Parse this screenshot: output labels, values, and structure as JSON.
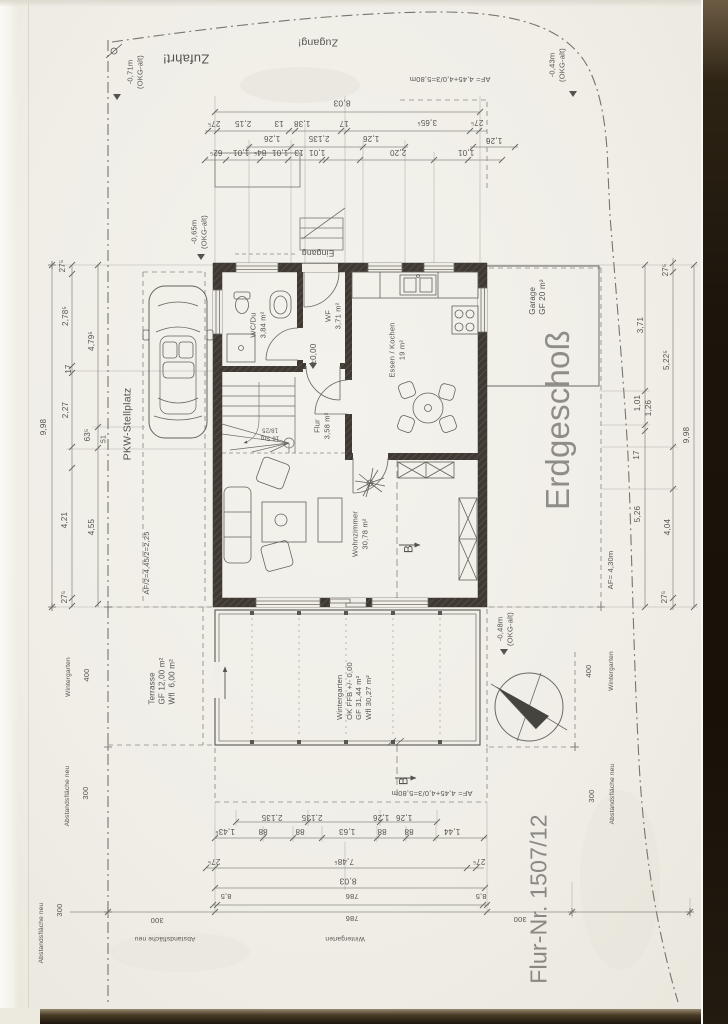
{
  "meta": {
    "document_type": "Scanned architectural floor plan",
    "floor_title": "Erdgeschoß",
    "parcel_number": "Flur-Nr. 1507/12"
  },
  "palette": {
    "paper": "#f0eee7",
    "ink": "#55534d",
    "wall": "#3f3933",
    "dim_line": "#8d8c85",
    "big_title": "#8f8d87",
    "scan_edge_dark": "#1b150c"
  },
  "annotations": [
    {
      "name": "label-zufahrt",
      "text": "Zufahrt!",
      "x": 186,
      "y": 58,
      "rot": 180,
      "size": 13
    },
    {
      "name": "label-zugang",
      "text": "Zugang!",
      "x": 318,
      "y": 42,
      "rot": 180,
      "size": 10.5
    },
    {
      "name": "level-note-071",
      "text": "-0,71m\n(OKG-alt)",
      "x": 135,
      "y": 72,
      "rot": -90,
      "size": 7.5
    },
    {
      "name": "level-note-043",
      "text": "-0,43m\n(OKG-alt)",
      "x": 557,
      "y": 65,
      "rot": -90,
      "size": 7.5
    },
    {
      "name": "af-formula-top",
      "text": "AF= 4,45+4,0/3=5,80m",
      "x": 450,
      "y": 79,
      "rot": 180,
      "size": 7.5
    },
    {
      "name": "dim-top-total",
      "text": "8,03",
      "x": 342,
      "y": 103,
      "rot": 180,
      "size": 8.5
    },
    {
      "name": "dim",
      "text": "27⁵",
      "x": 214,
      "y": 123,
      "rot": 180,
      "size": 8
    },
    {
      "name": "dim",
      "text": "2,15",
      "x": 243,
      "y": 123,
      "rot": 180,
      "size": 8
    },
    {
      "name": "dim",
      "text": "13",
      "x": 279,
      "y": 123,
      "rot": 180,
      "size": 8
    },
    {
      "name": "dim",
      "text": "1,38",
      "x": 302,
      "y": 123,
      "rot": 180,
      "size": 8
    },
    {
      "name": "dim",
      "text": "17",
      "x": 344,
      "y": 123,
      "rot": 180,
      "size": 8
    },
    {
      "name": "dim",
      "text": "3,65⁵",
      "x": 427,
      "y": 122,
      "rot": 180,
      "size": 8
    },
    {
      "name": "dim",
      "text": "27⁵",
      "x": 477,
      "y": 122,
      "rot": 180,
      "size": 8
    },
    {
      "name": "dim",
      "text": "1,26",
      "x": 272,
      "y": 138,
      "rot": 180,
      "size": 8
    },
    {
      "name": "dim",
      "text": "2,135",
      "x": 319,
      "y": 138,
      "rot": 180,
      "size": 8
    },
    {
      "name": "dim",
      "text": "1,26",
      "x": 371,
      "y": 138,
      "rot": 180,
      "size": 8
    },
    {
      "name": "dim",
      "text": "1,26",
      "x": 494,
      "y": 140,
      "rot": 180,
      "size": 8
    },
    {
      "name": "dim",
      "text": "62⁵",
      "x": 216,
      "y": 152,
      "rot": 180,
      "size": 8
    },
    {
      "name": "dim",
      "text": "1,01",
      "x": 241,
      "y": 152,
      "rot": 180,
      "size": 8
    },
    {
      "name": "dim",
      "text": "84⁵",
      "x": 260,
      "y": 152,
      "rot": 180,
      "size": 8
    },
    {
      "name": "dim",
      "text": "1,01",
      "x": 280,
      "y": 152,
      "rot": 180,
      "size": 8
    },
    {
      "name": "dim",
      "text": "13",
      "x": 299,
      "y": 152,
      "rot": 180,
      "size": 8
    },
    {
      "name": "dim",
      "text": "1,01",
      "x": 317,
      "y": 152,
      "rot": 180,
      "size": 8
    },
    {
      "name": "dim",
      "text": "2,20",
      "x": 398,
      "y": 152,
      "rot": 180,
      "size": 8
    },
    {
      "name": "dim",
      "text": "1,01",
      "x": 466,
      "y": 152,
      "rot": 180,
      "size": 8
    },
    {
      "name": "label-eingang",
      "text": "Eingang",
      "x": 318,
      "y": 253,
      "rot": 180,
      "size": 8.5
    },
    {
      "name": "level-note-065",
      "text": "-0,65m\n(OKG-alt)",
      "x": 199,
      "y": 232,
      "rot": -90,
      "size": 7.5
    },
    {
      "name": "room-wc",
      "text": "WC/Du\n3,84 m²",
      "x": 258,
      "y": 325,
      "rot": -90,
      "size": 7.5
    },
    {
      "name": "room-wf",
      "text": "WF\n3,71 m²",
      "x": 333,
      "y": 316,
      "rot": -90,
      "size": 7.5
    },
    {
      "name": "level-zero",
      "text": "±0,00",
      "x": 314,
      "y": 354,
      "rot": -90,
      "size": 8
    },
    {
      "name": "room-essen-kochen",
      "text": "Essen / Kochen\n19 m²",
      "x": 397,
      "y": 350,
      "rot": -90,
      "size": 7.5
    },
    {
      "name": "room-flur",
      "text": "Flur\n3,58 m²",
      "x": 322,
      "y": 426,
      "rot": -90,
      "size": 7.5
    },
    {
      "name": "stair-note",
      "text": "16 Stg\n18/25",
      "x": 270,
      "y": 433,
      "rot": 180,
      "size": 6
    },
    {
      "name": "room-wohnzimmer",
      "text": "Wohnzimmer\n30,78 m²",
      "x": 360,
      "y": 534,
      "rot": -90,
      "size": 7.5
    },
    {
      "name": "room-garage",
      "text": "Garage\nGF 20 m²",
      "x": 538,
      "y": 297,
      "rot": -90,
      "size": 8,
      "align": "left"
    },
    {
      "name": "floor-title",
      "text": "Erdgeschoß",
      "x": 558,
      "y": 420,
      "rot": -90,
      "size": 33,
      "color": "#8f8d87"
    },
    {
      "name": "parcel-number",
      "text": "Flur-Nr. 1507/12",
      "x": 539,
      "y": 899,
      "rot": -90,
      "size": 23,
      "color": "#8a8882"
    },
    {
      "name": "label-pkw-stellplatz",
      "text": "PKW-Stellplatz",
      "x": 128,
      "y": 424,
      "rot": -90,
      "size": 10.5
    },
    {
      "name": "dim",
      "text": "9,98",
      "x": 44,
      "y": 427,
      "rot": -90,
      "size": 8
    },
    {
      "name": "dim",
      "text": "27⁵",
      "x": 63,
      "y": 266,
      "rot": -90,
      "size": 8
    },
    {
      "name": "dim",
      "text": "2,78⁵",
      "x": 66,
      "y": 316,
      "rot": -90,
      "size": 8
    },
    {
      "name": "dim",
      "text": "17",
      "x": 69,
      "y": 369,
      "rot": -90,
      "size": 8
    },
    {
      "name": "dim",
      "text": "2,27",
      "x": 66,
      "y": 410,
      "rot": -90,
      "size": 8
    },
    {
      "name": "dim",
      "text": "4,21",
      "x": 65,
      "y": 520,
      "rot": -90,
      "size": 8
    },
    {
      "name": "dim",
      "text": "27⁵",
      "x": 65,
      "y": 597,
      "rot": -90,
      "size": 8
    },
    {
      "name": "dim",
      "text": "4,79⁵",
      "x": 92,
      "y": 341,
      "rot": -90,
      "size": 8
    },
    {
      "name": "dim",
      "text": "63⁵",
      "x": 88,
      "y": 435,
      "rot": -90,
      "size": 8
    },
    {
      "name": "dim",
      "text": "4,55",
      "x": 92,
      "y": 527,
      "rot": -90,
      "size": 8
    },
    {
      "name": "dim",
      "text": "51",
      "x": 105,
      "y": 439,
      "rot": -90,
      "size": 7
    },
    {
      "name": "af-formula-half",
      "text": "AF/2=4,45/2=2,25",
      "x": 147,
      "y": 563,
      "rot": -90,
      "size": 7.5
    },
    {
      "name": "zone-label",
      "text": "Wintergarten",
      "x": 69,
      "y": 677,
      "rot": -90,
      "size": 6.5
    },
    {
      "name": "zone-dim",
      "text": "400",
      "x": 87,
      "y": 675,
      "rot": -90,
      "size": 7.5
    },
    {
      "name": "zone-label",
      "text": "Abstandsfläche neu",
      "x": 68,
      "y": 796,
      "rot": -90,
      "size": 6.5
    },
    {
      "name": "zone-dim",
      "text": "300",
      "x": 86,
      "y": 793,
      "rot": -90,
      "size": 7.5
    },
    {
      "name": "zone-label",
      "text": "Abstandsfläche neu",
      "x": 42,
      "y": 933,
      "rot": -90,
      "size": 6.5
    },
    {
      "name": "zone-dim",
      "text": "300",
      "x": 60,
      "y": 910,
      "rot": -90,
      "size": 7.5
    },
    {
      "name": "dim",
      "text": "3,71",
      "x": 641,
      "y": 325,
      "rot": -90,
      "size": 8
    },
    {
      "name": "dim",
      "text": "1,01",
      "x": 638,
      "y": 403,
      "rot": -90,
      "size": 8
    },
    {
      "name": "dim",
      "text": "17",
      "x": 637,
      "y": 455,
      "rot": -90,
      "size": 8
    },
    {
      "name": "dim",
      "text": "5,26",
      "x": 638,
      "y": 514,
      "rot": -90,
      "size": 8
    },
    {
      "name": "dim",
      "text": "27⁵",
      "x": 666,
      "y": 270,
      "rot": -90,
      "size": 8
    },
    {
      "name": "dim",
      "text": "5,22⁵",
      "x": 667,
      "y": 360,
      "rot": -90,
      "size": 8
    },
    {
      "name": "dim",
      "text": "1,26",
      "x": 649,
      "y": 408,
      "rot": -90,
      "size": 8
    },
    {
      "name": "dim",
      "text": "4,04",
      "x": 668,
      "y": 527,
      "rot": -90,
      "size": 8
    },
    {
      "name": "dim",
      "text": "27⁵",
      "x": 665,
      "y": 597,
      "rot": -90,
      "size": 8
    },
    {
      "name": "dim",
      "text": "9,98",
      "x": 687,
      "y": 435,
      "rot": -90,
      "size": 8
    },
    {
      "name": "af-formula-430",
      "text": "AF= 4,30m",
      "x": 611,
      "y": 570,
      "rot": -90,
      "size": 7.5
    },
    {
      "name": "level-note-048",
      "text": "-0,48m\n(OKG-alt)",
      "x": 505,
      "y": 629,
      "rot": -90,
      "size": 7.5
    },
    {
      "name": "zone-dim",
      "text": "400",
      "x": 589,
      "y": 671,
      "rot": -90,
      "size": 7.5
    },
    {
      "name": "zone-label",
      "text": "Wintergarten",
      "x": 612,
      "y": 671,
      "rot": -90,
      "size": 6.5
    },
    {
      "name": "zone-dim",
      "text": "300",
      "x": 592,
      "y": 796,
      "rot": -90,
      "size": 7.5
    },
    {
      "name": "zone-label",
      "text": "Abstandsfläche neu",
      "x": 613,
      "y": 794,
      "rot": -90,
      "size": 6.5
    },
    {
      "name": "room-wintergarten",
      "text": "Wintergarten\nOK FFB +/- 0,00\nGF 31,44 m²\nWfl 30,27 m²",
      "x": 354,
      "y": 691,
      "rot": -90,
      "size": 7.5,
      "align": "left"
    },
    {
      "name": "room-terrasse",
      "text": "Terrasse\nGF 12,00 m²\nWfl  6,00 m²",
      "x": 163,
      "y": 681,
      "rot": -90,
      "size": 8,
      "align": "left"
    },
    {
      "name": "af-formula-bottom",
      "text": "AF= 4,45+4,0/3=5,80m",
      "x": 432,
      "y": 793,
      "rot": 180,
      "size": 7.5
    },
    {
      "name": "section-letter-b",
      "text": "B",
      "x": 409,
      "y": 549,
      "rot": -90,
      "size": 12
    },
    {
      "name": "section-letter-b",
      "text": "B",
      "x": 404,
      "y": 781,
      "rot": -90,
      "size": 12
    },
    {
      "name": "dim",
      "text": "2,135",
      "x": 272,
      "y": 817,
      "rot": 180,
      "size": 8
    },
    {
      "name": "dim",
      "text": "2,135",
      "x": 312,
      "y": 817,
      "rot": 180,
      "size": 8
    },
    {
      "name": "dim",
      "text": "1,26",
      "x": 381,
      "y": 817,
      "rot": 180,
      "size": 8
    },
    {
      "name": "dim",
      "text": "1,26",
      "x": 404,
      "y": 817,
      "rot": 180,
      "size": 8
    },
    {
      "name": "dim",
      "text": "1,43⁵",
      "x": 225,
      "y": 831,
      "rot": 180,
      "size": 8
    },
    {
      "name": "dim",
      "text": "88",
      "x": 263,
      "y": 831,
      "rot": 180,
      "size": 8
    },
    {
      "name": "dim",
      "text": "88",
      "x": 300,
      "y": 831,
      "rot": 180,
      "size": 8
    },
    {
      "name": "dim",
      "text": "1,63",
      "x": 347,
      "y": 831,
      "rot": 180,
      "size": 8
    },
    {
      "name": "dim",
      "text": "88",
      "x": 382,
      "y": 831,
      "rot": 180,
      "size": 8
    },
    {
      "name": "dim",
      "text": "88",
      "x": 409,
      "y": 831,
      "rot": 180,
      "size": 8
    },
    {
      "name": "dim",
      "text": "1,44",
      "x": 452,
      "y": 831,
      "rot": 180,
      "size": 8
    },
    {
      "name": "dim",
      "text": "27⁵",
      "x": 214,
      "y": 861,
      "rot": 180,
      "size": 8
    },
    {
      "name": "dim",
      "text": "7,48⁵",
      "x": 344,
      "y": 861,
      "rot": 180,
      "size": 8
    },
    {
      "name": "dim",
      "text": "27⁵",
      "x": 479,
      "y": 861,
      "rot": 180,
      "size": 8
    },
    {
      "name": "dim",
      "text": "8,03",
      "x": 348,
      "y": 881,
      "rot": 180,
      "size": 8.5
    },
    {
      "name": "dim",
      "text": "8,5",
      "x": 226,
      "y": 896,
      "rot": 180,
      "size": 7.5
    },
    {
      "name": "dim",
      "text": "786",
      "x": 352,
      "y": 896,
      "rot": 180,
      "size": 7.5
    },
    {
      "name": "dim",
      "text": "8,5",
      "x": 481,
      "y": 896,
      "rot": 180,
      "size": 7.5
    },
    {
      "name": "dim",
      "text": "300",
      "x": 157,
      "y": 920,
      "rot": 180,
      "size": 7.5
    },
    {
      "name": "dim",
      "text": "786",
      "x": 352,
      "y": 918,
      "rot": 180,
      "size": 7.5
    },
    {
      "name": "dim",
      "text": "300",
      "x": 520,
      "y": 919,
      "rot": 180,
      "size": 7.5
    },
    {
      "name": "zone-label",
      "text": "Abstandsfläche neu",
      "x": 165,
      "y": 938,
      "rot": 180,
      "size": 6.5
    },
    {
      "name": "zone-label",
      "text": "Wintergarten",
      "x": 345,
      "y": 938,
      "rot": 180,
      "size": 6.5
    }
  ]
}
